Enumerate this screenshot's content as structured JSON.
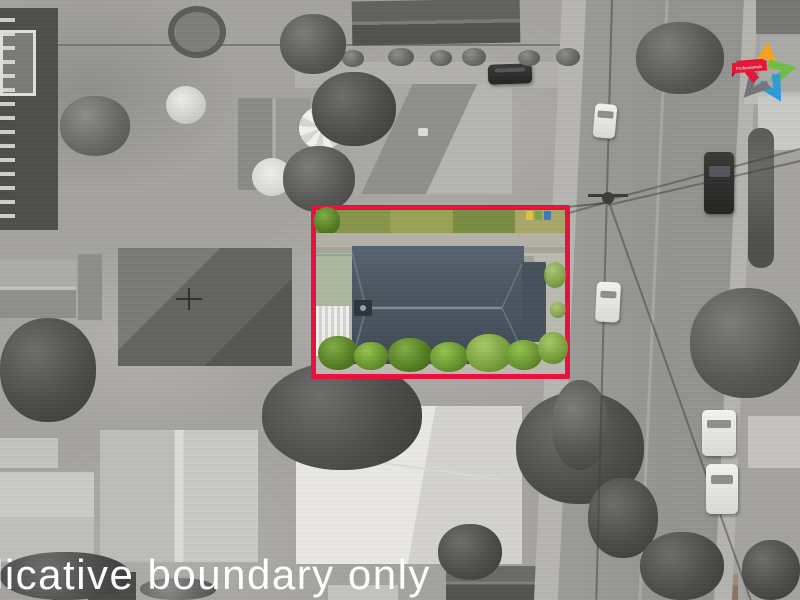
{
  "watermark": {
    "text": "licative boundary only",
    "color": "#ffffff"
  },
  "logo": {
    "banner_text": "Professionals",
    "star_colors": {
      "top": "#f6a21c",
      "right": "#6dbe45",
      "bottom_right": "#2d9bd7",
      "bottom_left": "#75767a",
      "banner_red": "#e21836"
    }
  },
  "boundary": {
    "stroke_color": "#e9103d"
  },
  "palette": {
    "road": "#9c9c9a",
    "sidewalk": "#b7b5b1",
    "ground": "#a5a3a0",
    "main_roof": "#4b5661",
    "roof_wing": "#46515c",
    "grass_strip": "#8a9650",
    "tree_green": "#6f9c35",
    "concrete_yard": "#bcb9b1",
    "sage_roof": "#abb8a1",
    "bin_colors": [
      "#d9c53b",
      "#7aa23c",
      "#3c79c0"
    ]
  }
}
